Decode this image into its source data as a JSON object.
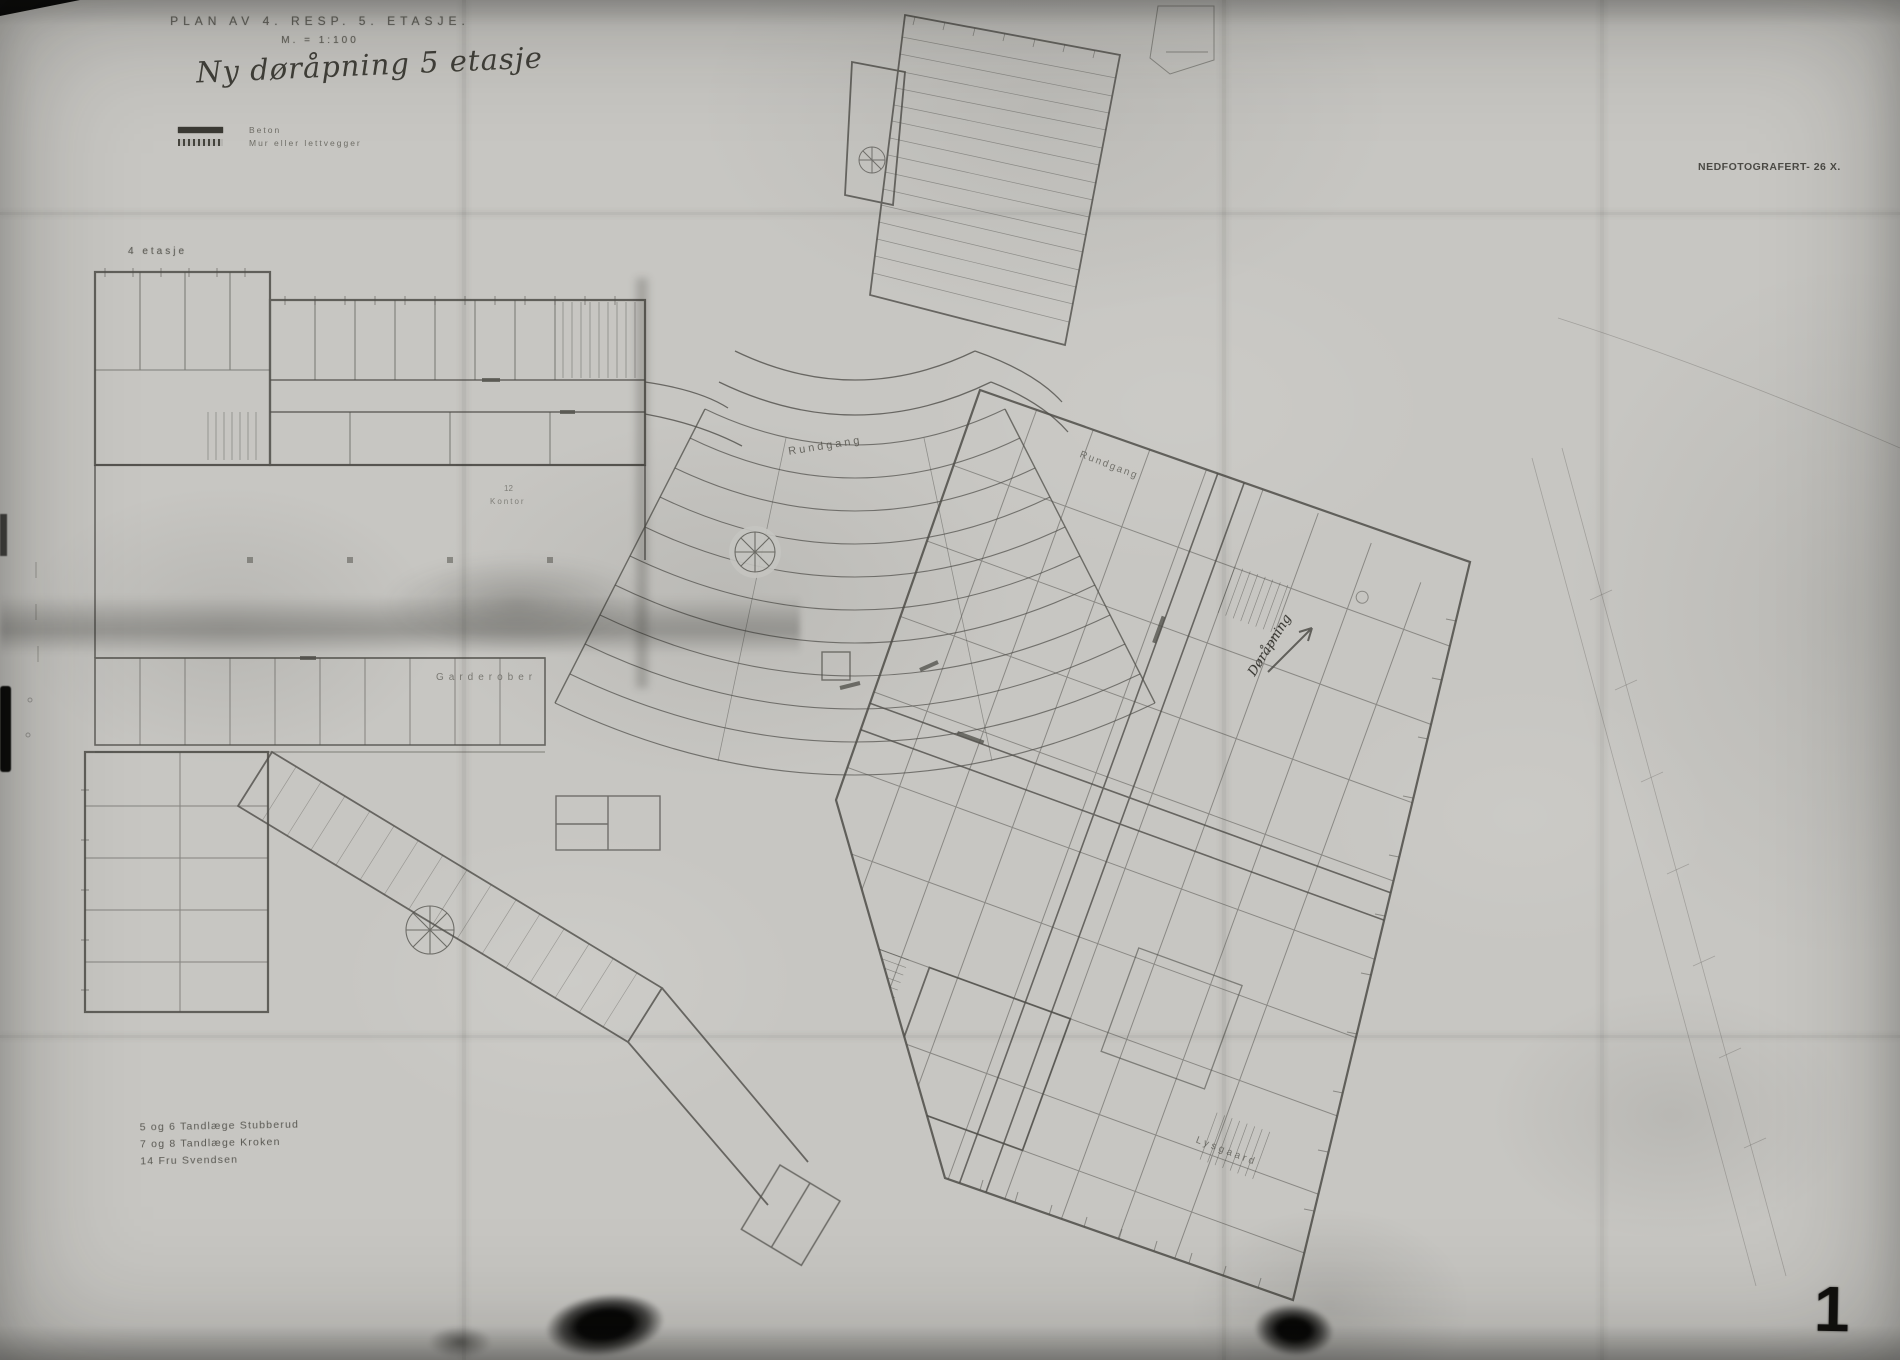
{
  "title": {
    "line1": "PLAN AV 4. RESP. 5. ETASJE.",
    "scale": "M. = 1:100",
    "note": "Ny døråpning 5 etasje"
  },
  "legend": {
    "items": [
      {
        "name": "beton",
        "label": "Beton"
      },
      {
        "name": "mur",
        "label": "Mur eller lettvegger"
      }
    ]
  },
  "labels": {
    "floor": "4 etasje",
    "garderobe": "Garderober",
    "rundgang_left": "Rundgang",
    "rundgang_right": "Rundgang",
    "lysgaard": "Lysgaard",
    "door_note": "Døråpning",
    "kontor": "Kontor",
    "room_no": "12"
  },
  "stamp": {
    "text": "NEDFOTOGRAFERT- 26 X."
  },
  "notes": {
    "lines": [
      "5 og 6 Tandlæge Stubberud",
      "7 og 8 Tandlæge Kroken",
      "14 Fru Svendsen"
    ]
  },
  "sheet": {
    "number": "1"
  },
  "colors": {
    "paper": "#c7c6c2",
    "ink": "#34332e"
  }
}
